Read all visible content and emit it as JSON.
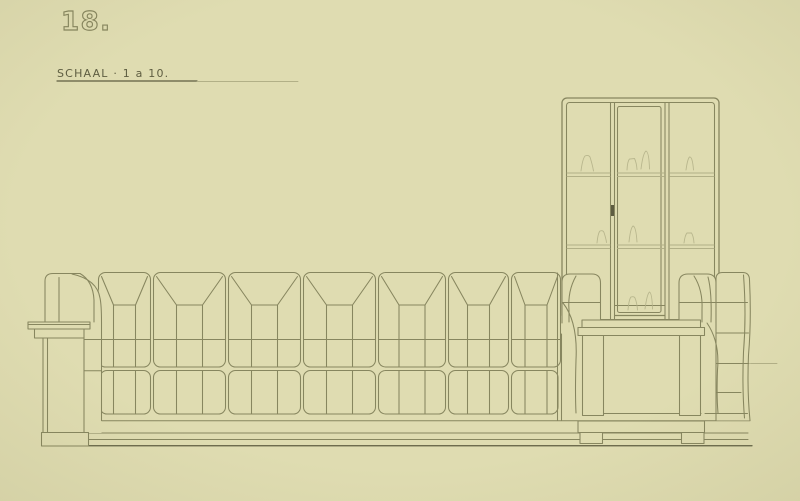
{
  "annotations": {
    "drawing_number": "18.",
    "scale_label": "SCHAAL · 1 a 10."
  },
  "colors": {
    "paper": "#dfdcb1",
    "ink": "#87865f",
    "ink_dark": "#5e5d41",
    "ink_faint": "#b2b087"
  },
  "drawing": {
    "type": "hand-drawn furniture elevation",
    "elements": [
      "long tufted sofa with pleated back cushions",
      "left armrest with stepped side ledge",
      "glazed three-panel display cabinet with two shelves",
      "stepped cabinet pedestal with block feet",
      "continuous base plinth"
    ]
  }
}
